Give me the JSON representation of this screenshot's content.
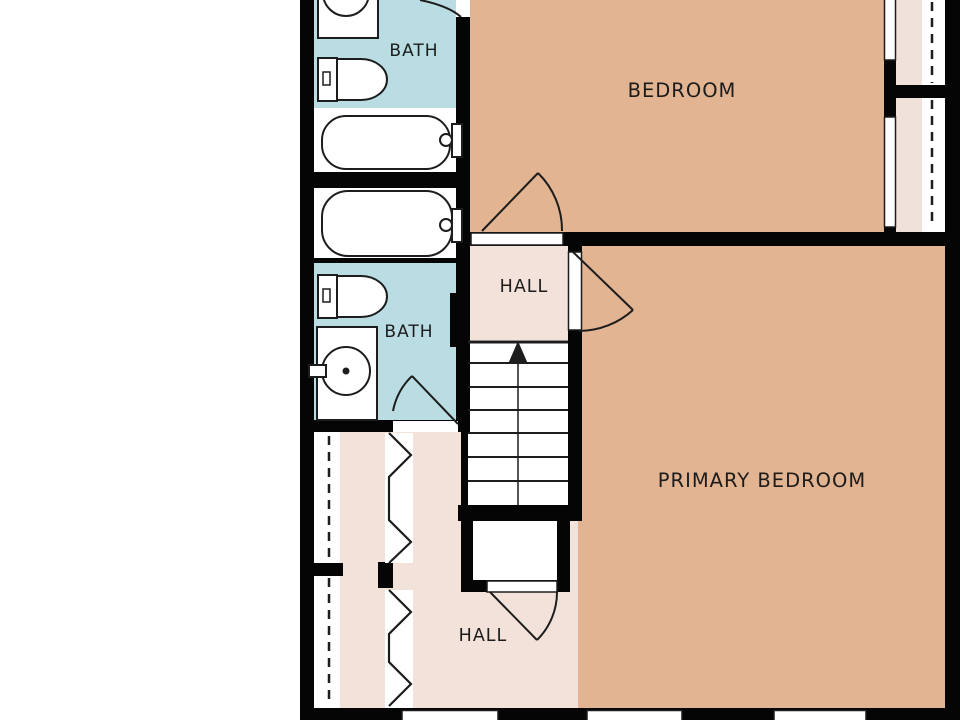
{
  "plan": {
    "type": "floor-plan",
    "floor": "upper-level",
    "rooms": {
      "bath_upper": {
        "label": "BATH"
      },
      "bath_lower": {
        "label": "BATH"
      },
      "bedroom": {
        "label": "BEDROOM"
      },
      "primary_bedroom": {
        "label": "PRIMARY BEDROOM"
      },
      "hall_upper": {
        "label": "HALL"
      },
      "hall_lower": {
        "label": "HALL"
      }
    },
    "stairs": {
      "direction": "up",
      "treads": 7
    },
    "fixtures": [
      "sink-vanity",
      "toilet",
      "bathtub",
      "toilet",
      "bathtub",
      "round-basin-vanity",
      "closet-rod",
      "bifold-doors",
      "windows",
      "door-swings"
    ]
  },
  "colors": {
    "wall": "#050505",
    "line": "#1d1d1d",
    "bath": "#b9dde2",
    "bedroom": "#e2b492",
    "hall": "#f3e2da",
    "closet": "#f0e1da",
    "fixture_fill": "#ffffff",
    "text": "#1c1c1c",
    "background": "#ffffff"
  }
}
